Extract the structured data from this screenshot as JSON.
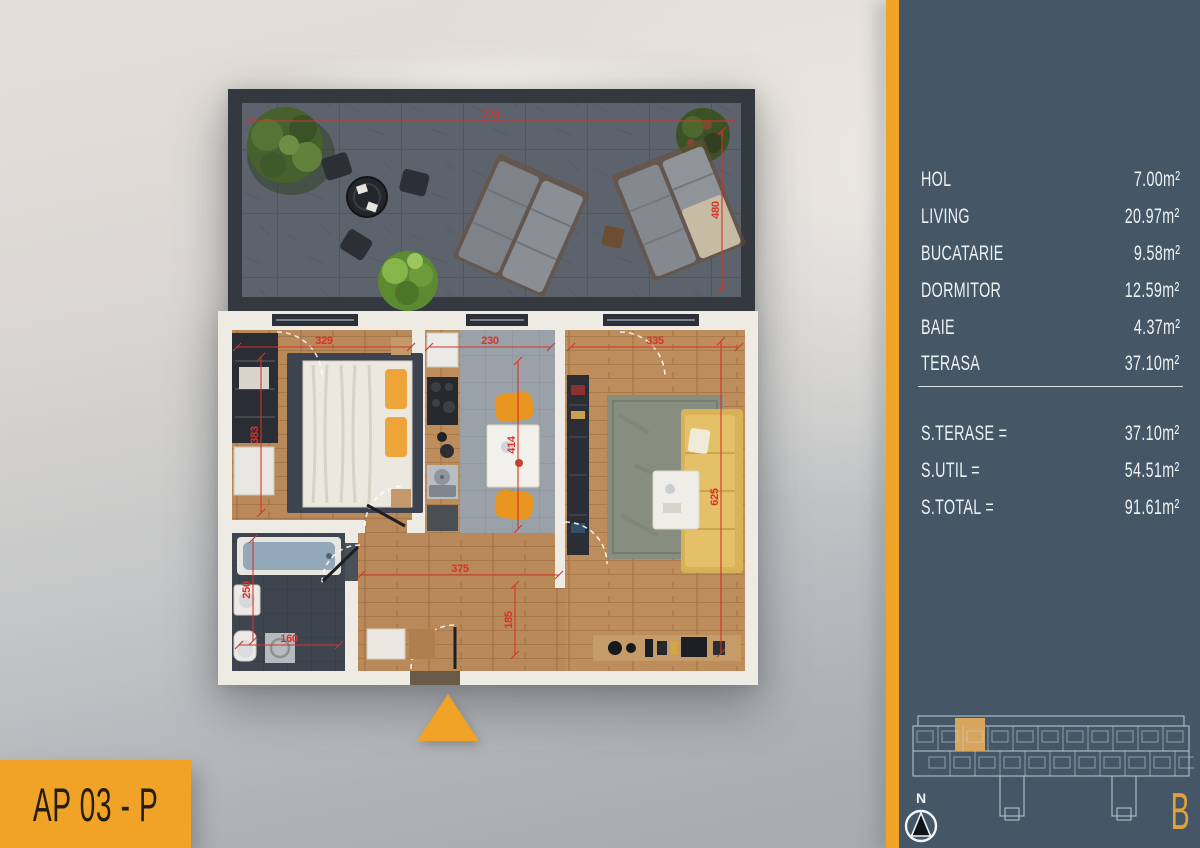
{
  "colors": {
    "accent": "#f0a327",
    "panel": "#455767",
    "dimension_red": "#d93226",
    "keyplan_highlight": "#d8a55c",
    "keyplan_line": "#c9d6de",
    "sidebar_text": "#edf1f3"
  },
  "plan": {
    "apartment_label": "AP 03 - P",
    "dimensions": [
      {
        "label": "773",
        "x1": 34,
        "y1": 36,
        "x2": 518,
        "y2": 36
      },
      {
        "label": "480",
        "x1": 507,
        "y1": 46,
        "x2": 507,
        "y2": 204
      },
      {
        "label": "329",
        "x1": 22,
        "y1": 262,
        "x2": 196,
        "y2": 262
      },
      {
        "label": "230",
        "x1": 214,
        "y1": 262,
        "x2": 336,
        "y2": 262
      },
      {
        "label": "335",
        "x1": 356,
        "y1": 262,
        "x2": 524,
        "y2": 262
      },
      {
        "label": "383",
        "x1": 46,
        "y1": 272,
        "x2": 46,
        "y2": 428
      },
      {
        "label": "414",
        "x1": 303,
        "y1": 276,
        "x2": 303,
        "y2": 444
      },
      {
        "label": "625",
        "x1": 506,
        "y1": 256,
        "x2": 506,
        "y2": 568
      },
      {
        "label": "375",
        "x1": 146,
        "y1": 490,
        "x2": 344,
        "y2": 490
      },
      {
        "label": "185",
        "x1": 300,
        "y1": 500,
        "x2": 300,
        "y2": 570
      },
      {
        "label": "250",
        "x1": 38,
        "y1": 454,
        "x2": 38,
        "y2": 556
      },
      {
        "label": "160",
        "x1": 24,
        "y1": 560,
        "x2": 124,
        "y2": 560
      }
    ]
  },
  "sidebar": {
    "rooms": [
      {
        "label": "HOL",
        "area": "7.00m²"
      },
      {
        "label": "LIVING",
        "area": "20.97m²"
      },
      {
        "label": "BUCATARIE",
        "area": "9.58m²"
      },
      {
        "label": "DORMITOR",
        "area": "12.59m²"
      },
      {
        "label": "BAIE",
        "area": "4.37m²"
      },
      {
        "label": "TERASA",
        "area": "37.10m²"
      }
    ],
    "totals": [
      {
        "label": "S.TERASE =",
        "value": "37.10m²"
      },
      {
        "label": "S.UTIL =",
        "value": "54.51m²"
      },
      {
        "label": "S.TOTAL =",
        "value": "91.61m²"
      }
    ],
    "compass_label": "N",
    "building_letter": "B"
  }
}
